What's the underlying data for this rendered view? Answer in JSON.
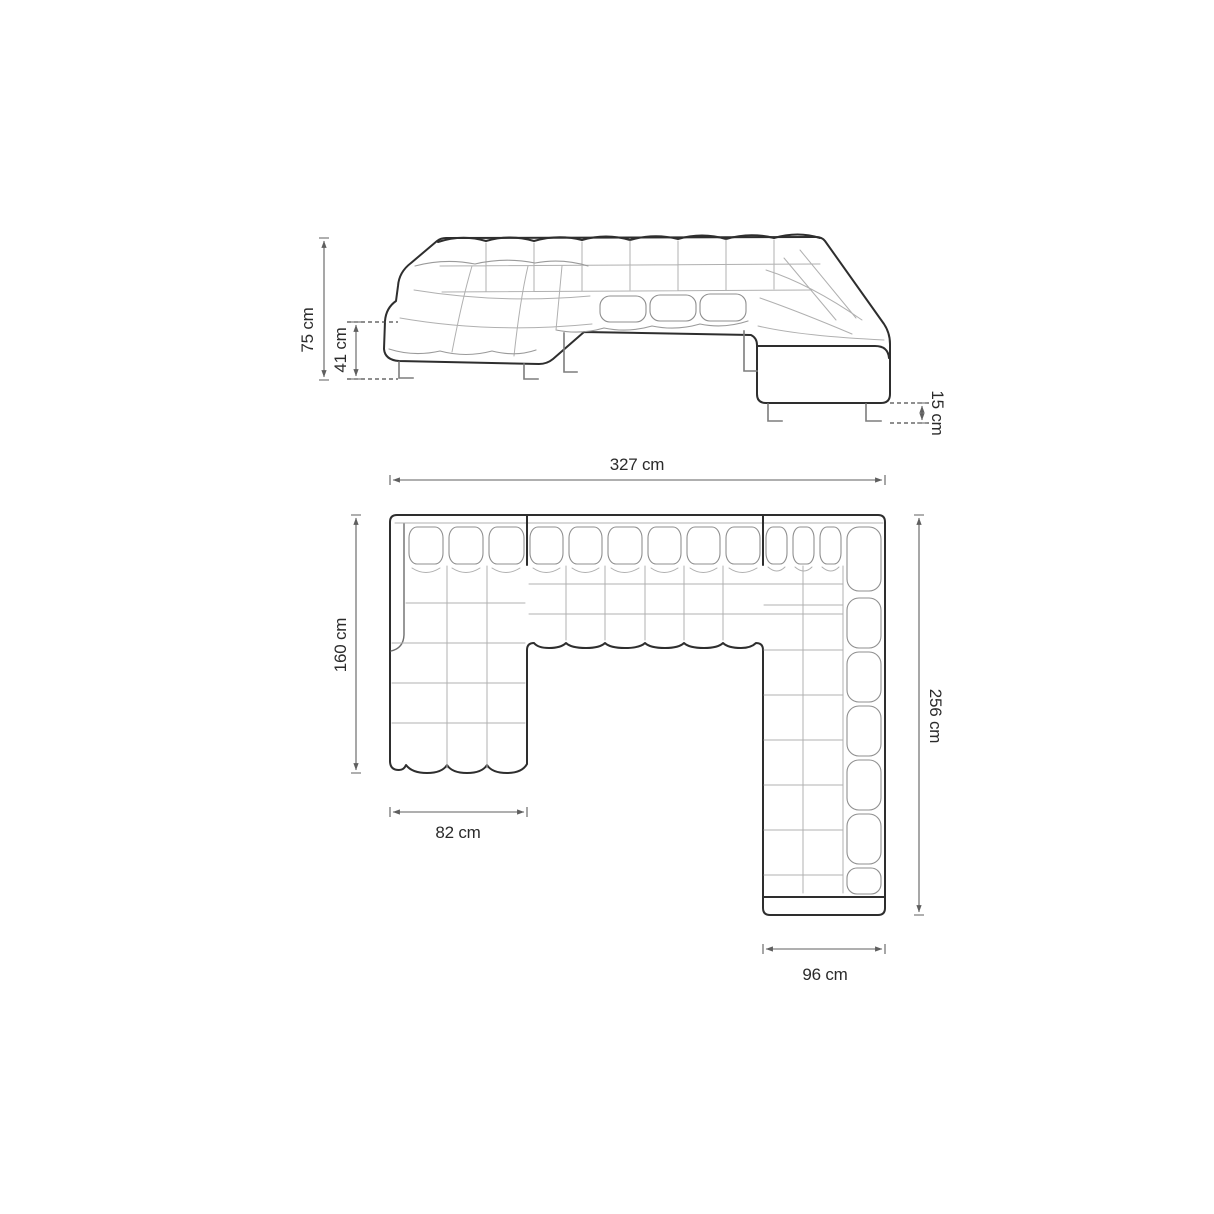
{
  "page": {
    "background_color": "#ffffff"
  },
  "diagram": {
    "colors": {
      "main_outline": "#2e2e2e",
      "tuft_lines": "#b0b0b0",
      "dimension_lines": "#5f5f5f",
      "label_text": "#2b2b2b"
    },
    "unit": "cm",
    "views": {
      "elevation": {
        "total_height": "75 cm",
        "seat_height": "41 cm",
        "leg_height": "15 cm"
      },
      "plan": {
        "total_width": "327 cm",
        "left_chaise_length": "160 cm",
        "left_chaise_width": "82 cm",
        "right_section_length": "256 cm",
        "right_section_width": "96 cm"
      }
    },
    "measurements": {
      "total_height_cm": 75,
      "seat_height_cm": 41,
      "leg_height_cm": 15,
      "total_width_cm": 327,
      "left_chaise_length_cm": 160,
      "left_chaise_width_cm": 82,
      "right_section_length_cm": 256,
      "right_section_width_cm": 96
    }
  }
}
